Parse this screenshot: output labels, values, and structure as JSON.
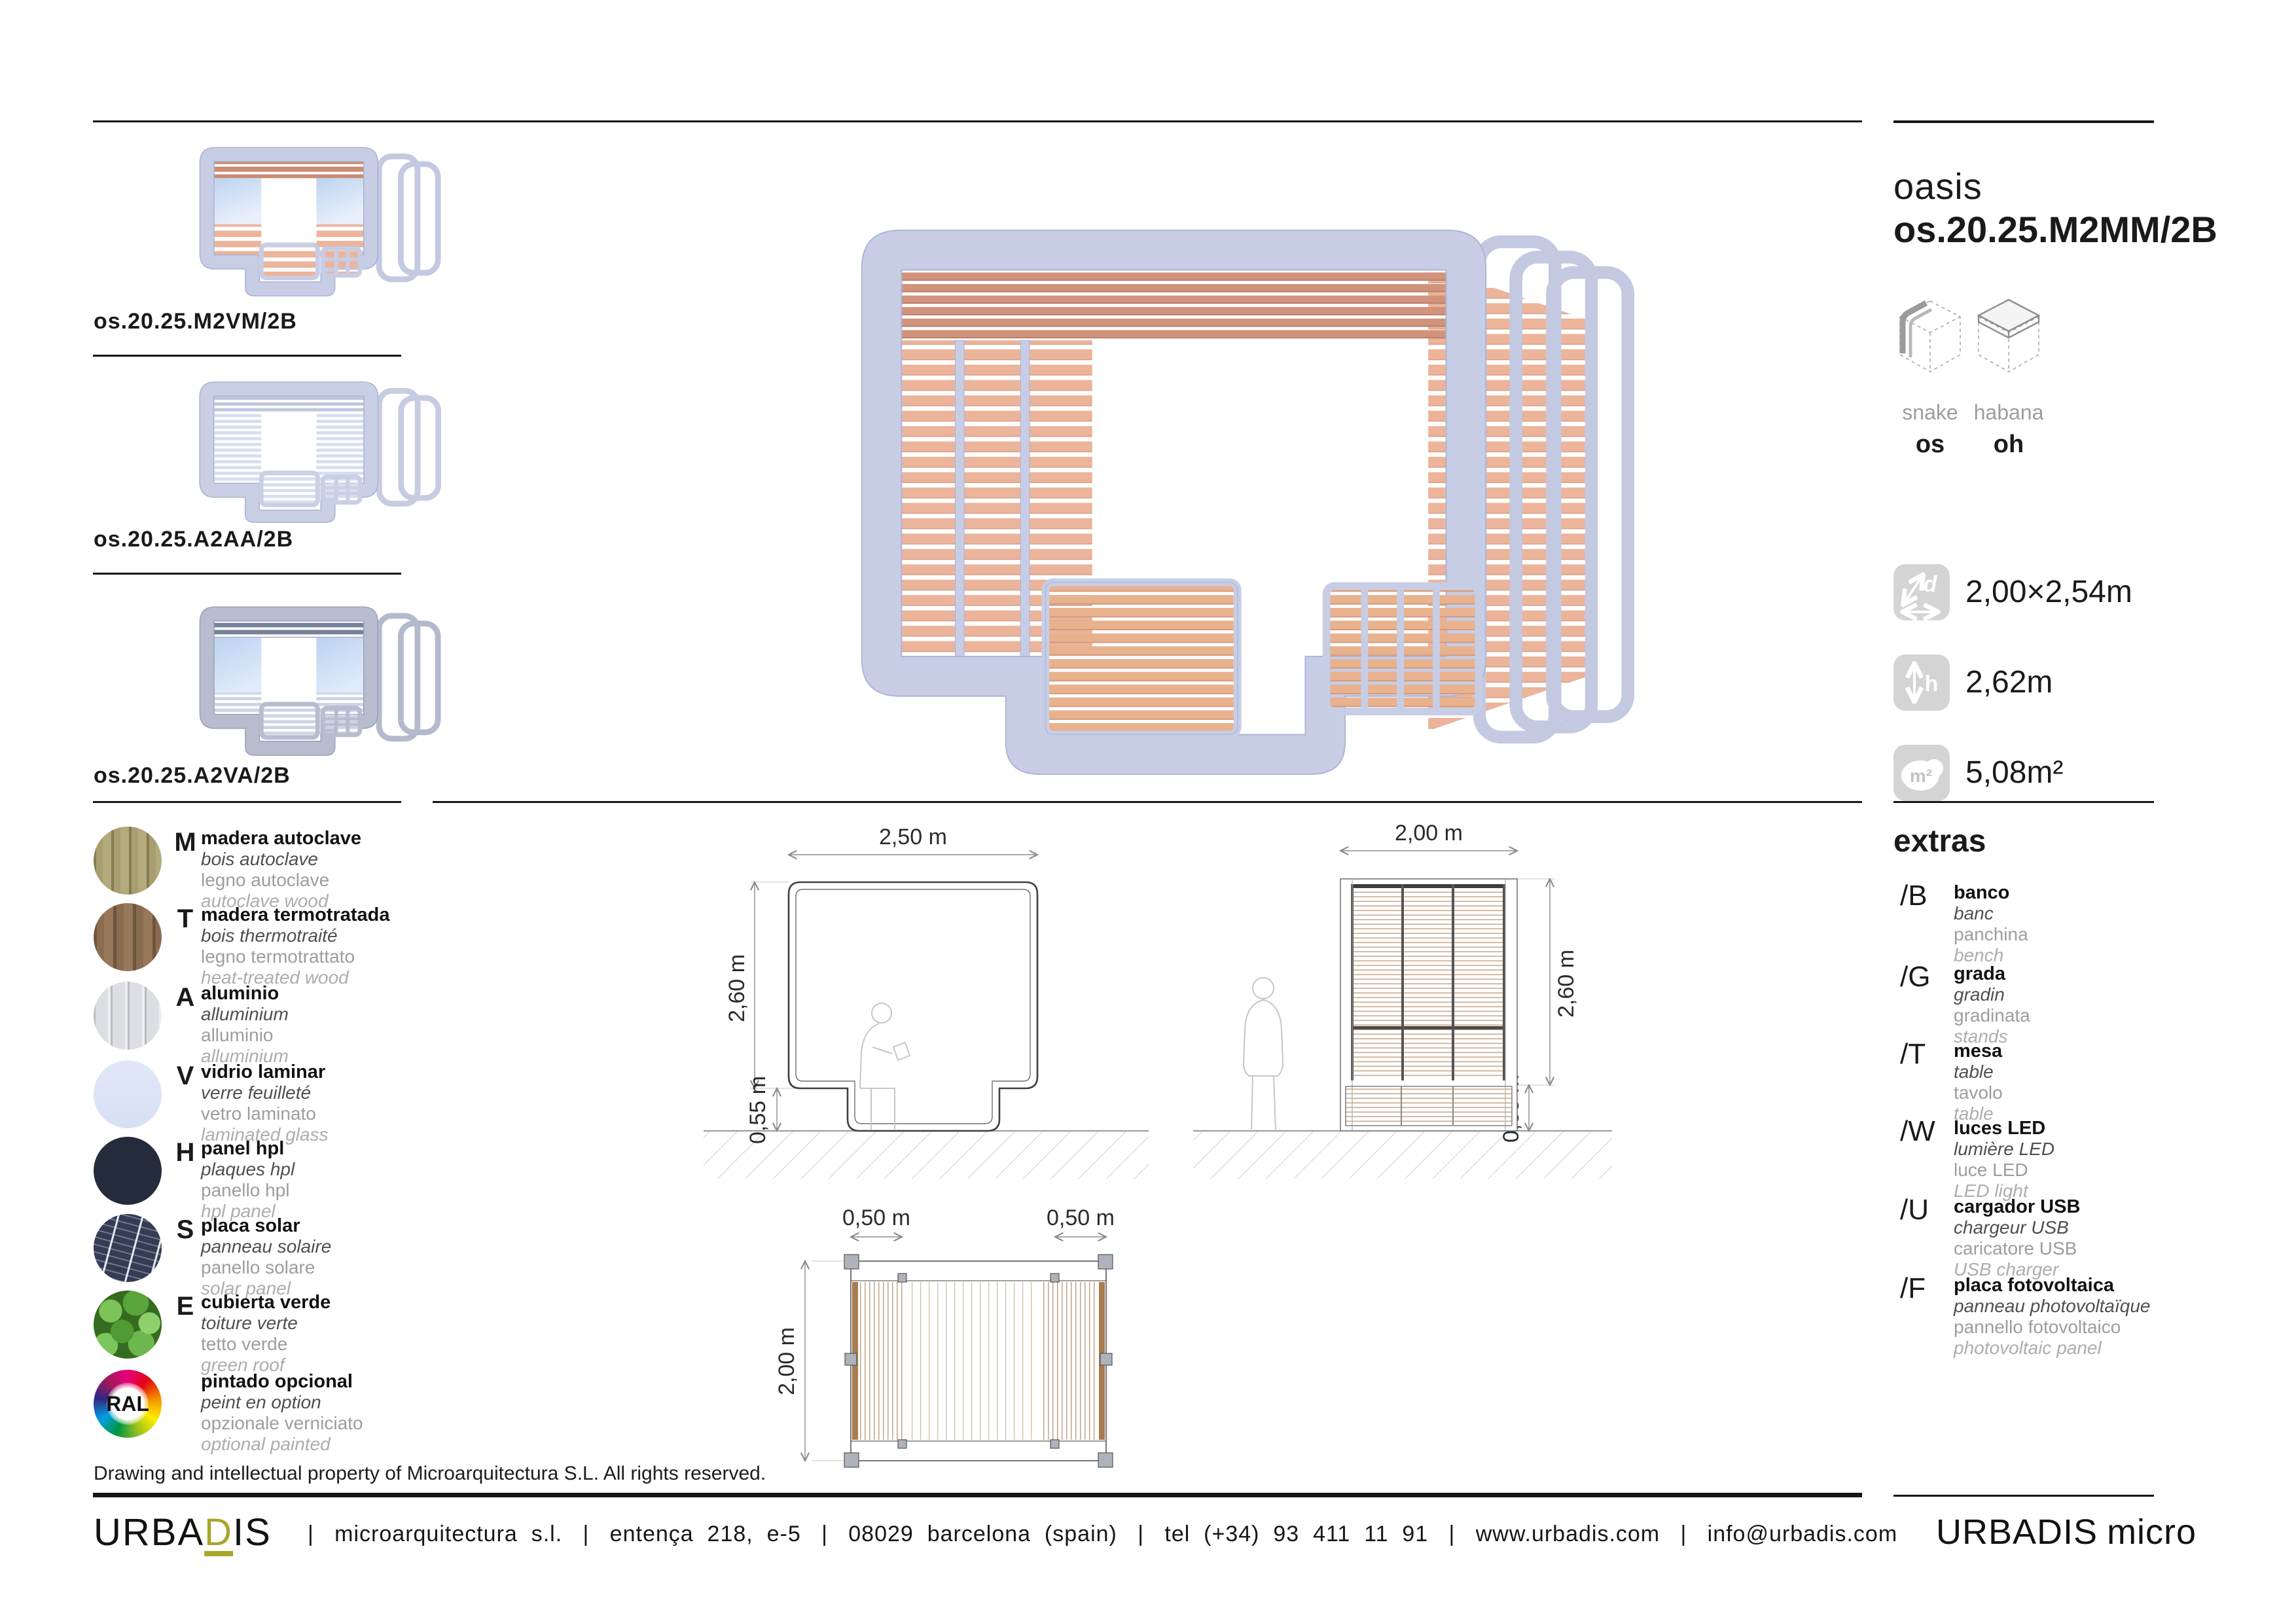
{
  "product": {
    "family": "oasis",
    "code": "os.20.25.M2MM/2B"
  },
  "models": {
    "a": {
      "name": "snake",
      "code": "os"
    },
    "b": {
      "name": "habana",
      "code": "oh"
    }
  },
  "specs": {
    "footprint": {
      "value": "2,00×2,54m",
      "glyph": "d"
    },
    "height": {
      "value": "2,62m",
      "glyph": "h"
    },
    "area": {
      "value": "5,08m²",
      "glyph": "m²"
    }
  },
  "variants": {
    "items": [
      {
        "code": "os.20.25.M2VM/2B"
      },
      {
        "code": "os.20.25.A2AA/2B"
      },
      {
        "code": "os.20.25.A2VA/2B"
      }
    ]
  },
  "materials": {
    "items": [
      {
        "letter": "M",
        "l1": "madera autoclave",
        "l2": "bois autoclave",
        "l3": "legno autoclave",
        "l4": "autoclave wood"
      },
      {
        "letter": "T",
        "l1": "madera termotratada",
        "l2": "bois thermotraité",
        "l3": "legno termotrattato",
        "l4": "heat-treated wood"
      },
      {
        "letter": "A",
        "l1": "aluminio",
        "l2": "alluminium",
        "l3": "alluminio",
        "l4": "alluminium"
      },
      {
        "letter": "V",
        "l1": "vidrio laminar",
        "l2": "verre feuilleté",
        "l3": "vetro laminato",
        "l4": "laminated glass"
      },
      {
        "letter": "H",
        "l1": "panel hpl",
        "l2": "plaques hpl",
        "l3": "panello hpl",
        "l4": "hpl panel"
      },
      {
        "letter": "S",
        "l1": "placa solar",
        "l2": "panneau solaire",
        "l3": "panello solare",
        "l4": "solar panel"
      },
      {
        "letter": "E",
        "l1": "cubierta verde",
        "l2": "toiture verte",
        "l3": "tetto verde",
        "l4": "green roof"
      },
      {
        "letter": "RAL",
        "l1": "pintado opcional",
        "l2": "peint en option",
        "l3": "opzionale verniciato",
        "l4": "optional painted"
      }
    ]
  },
  "extras": {
    "title": "extras",
    "items": [
      {
        "code": "/B",
        "l1": "banco",
        "l2": "banc",
        "l3": "panchina",
        "l4": "bench"
      },
      {
        "code": "/G",
        "l1": "grada",
        "l2": "gradin",
        "l3": "gradinata",
        "l4": "stands"
      },
      {
        "code": "/T",
        "l1": "mesa",
        "l2": "table",
        "l3": "tavolo",
        "l4": "table"
      },
      {
        "code": "/W",
        "l1": "luces LED",
        "l2": "lumière LED",
        "l3": "luce LED",
        "l4": "LED light"
      },
      {
        "code": "/U",
        "l1": "cargador USB",
        "l2": "chargeur USB",
        "l3": "caricatore USB",
        "l4": "USB charger"
      },
      {
        "code": "/F",
        "l1": "placa fotovoltaica",
        "l2": "panneau photovoltaïque",
        "l3": "pannello fotovoltaico",
        "l4": "photovoltaic panel"
      }
    ]
  },
  "drawings": {
    "front": {
      "w": "2,50 m",
      "h": "2,60 m",
      "bench": "0,55 m"
    },
    "side": {
      "w": "2,00 m",
      "h": "2,60 m",
      "bench": "0,55 m"
    },
    "plan": {
      "left": "0,50 m",
      "right": "0,50 m",
      "depth": "2,00 m"
    }
  },
  "copyright": "Drawing and intellectual property of Microarquitectura S.L. All rights reserved.",
  "footer": {
    "brand_pre": "URBA",
    "brand_accent": "D",
    "brand_post": "IS",
    "address": "|   microarquitectura  s.l.   |   entença  218,  e-5   |   08029  barcelona  (spain)   |   tel  (+34)  93  411  11  91   |   www.urbadis.com   |   info@urbadis.com",
    "brand_suffix": "micro"
  },
  "colors": {
    "accent": "#a8a62b",
    "frame": "#c7cde5",
    "wood": "#ecb49a",
    "glass": "#d9e4f6",
    "hpl": "#242c3c"
  }
}
